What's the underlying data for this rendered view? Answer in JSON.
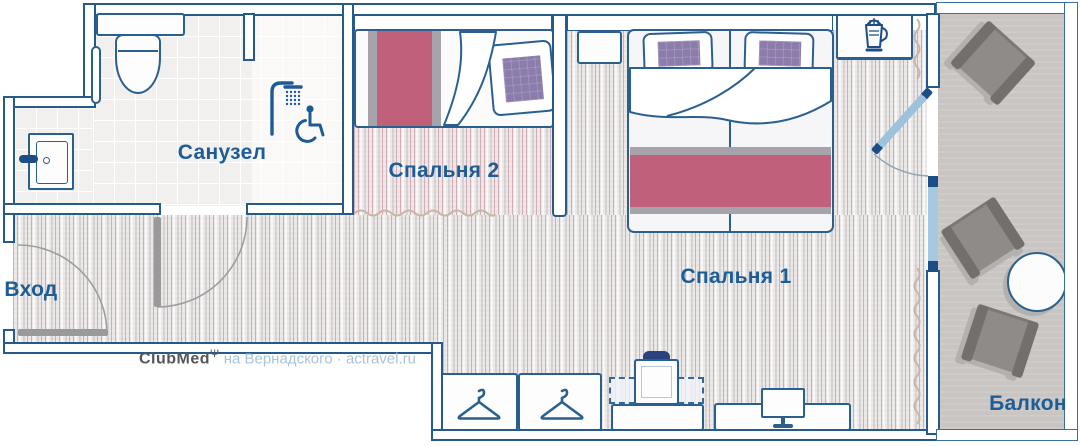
{
  "rooms": {
    "bathroom": {
      "label": "Санузел"
    },
    "bedroom2": {
      "label": "Спальня 2"
    },
    "bedroom1": {
      "label": "Спальня 1"
    },
    "entrance": {
      "label": "Вход"
    },
    "balcony": {
      "label": "Балкон"
    }
  },
  "watermark": {
    "brand": "ClubMed",
    "symbol": "Ψ",
    "text": "на Вернадского · actravel.ru"
  },
  "icons": {
    "bathroom": [
      "toilet-icon",
      "sink-icon",
      "towel-rail-icon",
      "shower-icon",
      "wheelchair-icon"
    ],
    "bedroom2": [
      "single-bed",
      "pillow"
    ],
    "bedroom1": [
      "double-bed",
      "pillows",
      "nightstand",
      "kettle-icon"
    ],
    "storage": [
      "wardrobe-hanger-icon",
      "wardrobe-hanger-icon",
      "luggage-rack",
      "suitcase-icon"
    ],
    "desk": [
      "monitor-icon"
    ],
    "balcony": [
      "chair",
      "chair",
      "chair",
      "round-table"
    ],
    "openings": [
      "entrance-door",
      "bathroom-door",
      "balcony-door",
      "window",
      "curtain-wave"
    ]
  },
  "colors": {
    "wall_outline": "#265a8b",
    "label_text": "#1d5c94",
    "bed_accent_red": "#c0607a",
    "pillow_purple": "#8c7cab",
    "window_glass": "#a5c9e0",
    "door_leaf_gray": "#9a9a9a",
    "carpet_base": "#e9e5e5",
    "balcony_floor": "#c8c5c2"
  }
}
